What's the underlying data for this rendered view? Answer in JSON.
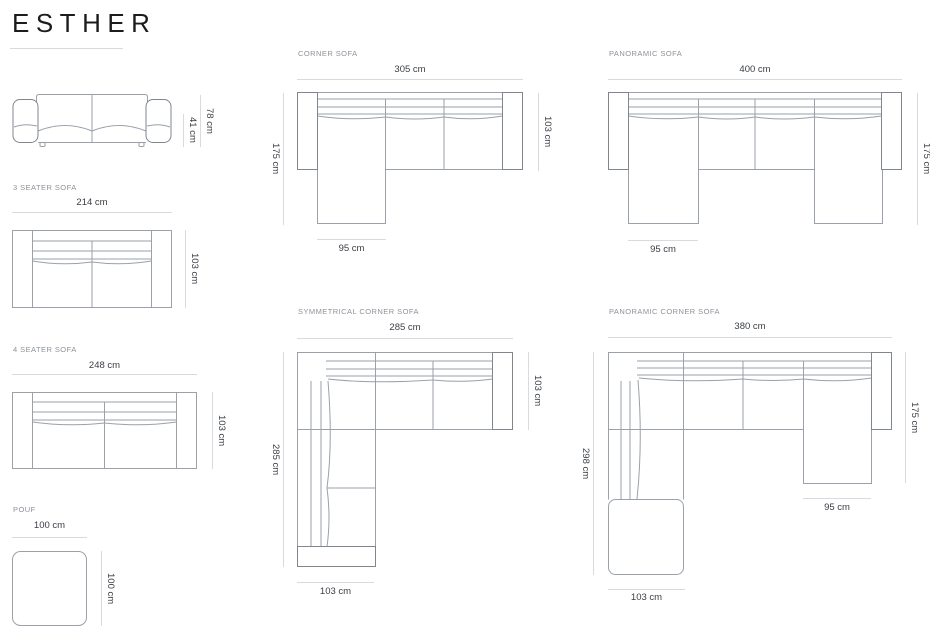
{
  "brand": {
    "name": "ESTHER"
  },
  "front_view": {
    "height": "78 cm",
    "seat_height": "41 cm"
  },
  "three_seater": {
    "label": "3 SEATER SOFA",
    "width": "214 cm",
    "depth": "103 cm"
  },
  "four_seater": {
    "label": "4 SEATER SOFA",
    "width": "248 cm",
    "depth": "103 cm"
  },
  "pouf": {
    "label": "POUF",
    "width": "100 cm",
    "height": "100 cm"
  },
  "corner": {
    "label": "CORNER SOFA",
    "width": "305 cm",
    "side_depth": "175 cm",
    "seat_depth": "103 cm",
    "chaise_width": "95 cm"
  },
  "panoramic": {
    "label": "PANORAMIC SOFA",
    "width": "400 cm",
    "side_depth": "175 cm",
    "chaise_width": "95 cm"
  },
  "symmetrical_corner": {
    "label": "SYMMETRICAL CORNER SOFA",
    "width": "285 cm",
    "side_depth": "285 cm",
    "seat_depth": "103 cm",
    "bottom_width": "103 cm"
  },
  "panoramic_corner": {
    "label": "PANORAMIC CORNER SOFA",
    "width": "380 cm",
    "side_depth": "298 cm",
    "right_depth": "175 cm",
    "chaise_width": "95 cm",
    "bottom_width": "103 cm"
  },
  "colors": {
    "outline": "#9aa1a8",
    "armrest_outline": "#7f868d",
    "dimension_line": "#d8dadd",
    "dimension_text": "#393e44",
    "label_text": "#8d9298",
    "title_text": "#1c1c1e"
  }
}
